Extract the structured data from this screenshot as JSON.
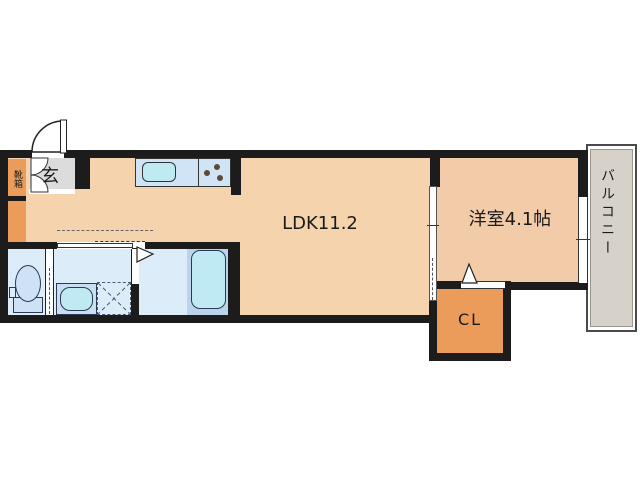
{
  "plan": {
    "type": "japanese-apartment-floor-plan",
    "rooms": {
      "ldk": {
        "label": "LDK11.2"
      },
      "western_room": {
        "label": "洋室4.1帖"
      },
      "closet": {
        "label": "CL"
      },
      "balcony": {
        "label": "バルコニー"
      },
      "entrance": {
        "label": "玄"
      },
      "shoe_box": {
        "label": "靴箱"
      }
    },
    "fixtures": [
      "entrance-door-swing",
      "shoe-box-double-door",
      "kitchen-counter",
      "kitchen-sink",
      "stove-burners",
      "toilet",
      "vanity-sink",
      "washing-machine-space",
      "bathtub",
      "sliding-door-washroom",
      "sliding-door-western-room",
      "closet-door",
      "balcony-window"
    ],
    "colors": {
      "wall": "#1c1c1c",
      "ldk_floor": "#f5d3ac",
      "room_floor": "#f2cba9",
      "storage_orange": "#eb9c5b",
      "entrance_gray": "#dcdcdc",
      "balcony_gray": "#d6d2ca",
      "wet_floor": "#ddecf9",
      "bath_zone": "#bcd3ec",
      "counter_blue": "#d0e4f6",
      "fixture_cyan": "#bfeaf4",
      "fixture_blue": "#cfe1f5",
      "line_dark": "#222222"
    }
  }
}
